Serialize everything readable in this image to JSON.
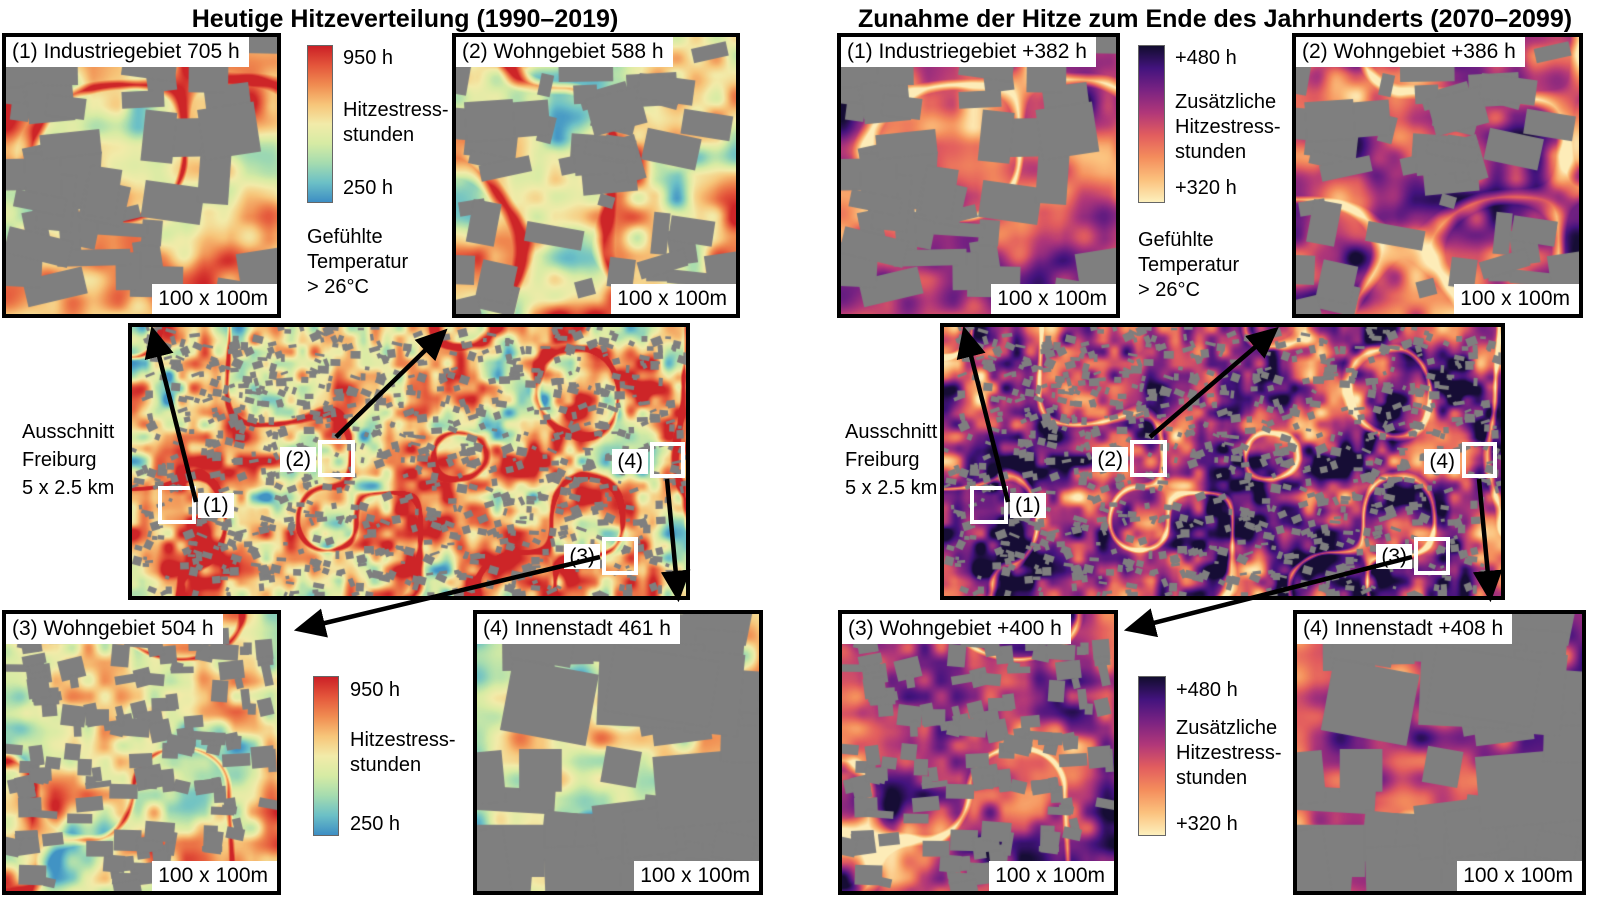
{
  "panels": [
    {
      "title": "Heutige Hitzeverteilung (1990–2019)",
      "map_caption": "Ausschnitt\nFreiburg\n5 x 2.5 km",
      "colorbar": {
        "max": "950 h",
        "label": "Hitzestress-\nstunden",
        "min": "250 h"
      },
      "note": "Gefühlte\nTemperatur\n> 26°C",
      "insets": [
        {
          "label": "(1) Industriegebiet 705 h",
          "scale": "100 x 100m"
        },
        {
          "label": "(2) Wohngebiet 588 h",
          "scale": "100 x 100m"
        },
        {
          "label": "(3) Wohngebiet 504 h",
          "scale": "100 x 100m"
        },
        {
          "label": "(4) Innenstadt 461 h",
          "scale": "100 x 100m"
        }
      ],
      "markers": [
        "(1)",
        "(2)",
        "(3)",
        "(4)"
      ],
      "palette": [
        "#cb2026",
        "#e4563b",
        "#f08c51",
        "#f7c579",
        "#f2eba9",
        "#d6eba4",
        "#a5dcaf",
        "#6cc0c6",
        "#3d8ec4"
      ]
    },
    {
      "title": "Zunahme der Hitze zum Ende des Jahrhunderts (2070–2099)",
      "map_caption": "Ausschnitt\nFreiburg\n5 x 2.5 km",
      "colorbar": {
        "max": "+480 h",
        "label": "Zusätzliche\nHitzestress-\nstunden",
        "min": "+320 h"
      },
      "note": "Gefühlte\nTemperatur\n> 26°C",
      "insets": [
        {
          "label": "(1) Industriegebiet +382 h",
          "scale": "100 x 100m"
        },
        {
          "label": "(2) Wohngebiet +386 h",
          "scale": "100 x 100m"
        },
        {
          "label": "(3) Wohngebiet +400 h",
          "scale": "100 x 100m"
        },
        {
          "label": "(4) Innenstadt +408 h",
          "scale": "100 x 100m"
        }
      ],
      "markers": [
        "(1)",
        "(2)",
        "(3)",
        "(4)"
      ],
      "palette": [
        "#120d2e",
        "#43137e",
        "#7b2382",
        "#b13779",
        "#e25d5e",
        "#f48d5c",
        "#fbc17d",
        "#fdf0bd"
      ]
    }
  ],
  "colors": {
    "building_gray": "#7f7f7f"
  }
}
